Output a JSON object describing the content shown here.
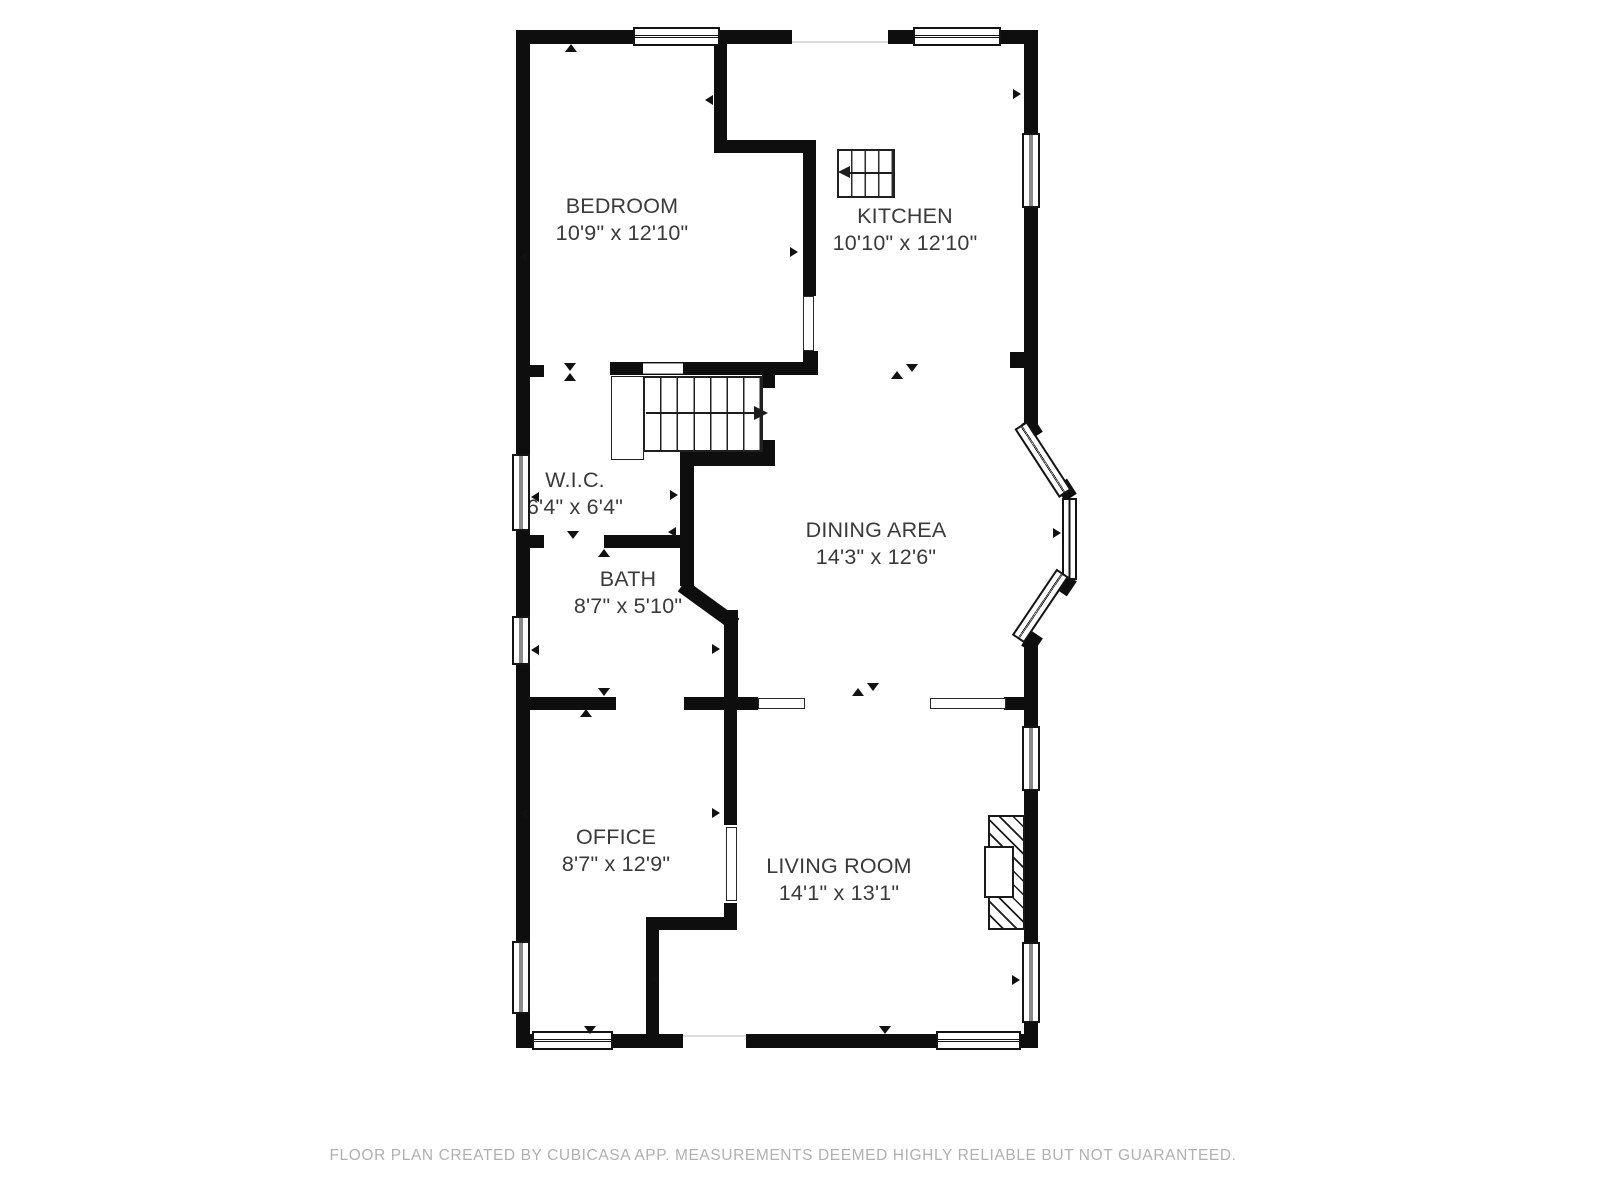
{
  "footer": "FLOOR PLAN CREATED BY CUBICASA APP. MEASUREMENTS DEEMED HIGHLY RELIABLE BUT NOT GUARANTEED.",
  "rooms": [
    {
      "id": "bedroom",
      "name": "BEDROOM",
      "dims": "10'9\" x 12'10\""
    },
    {
      "id": "kitchen",
      "name": "KITCHEN",
      "dims": "10'10\" x 12'10\""
    },
    {
      "id": "wic",
      "name": "W.I.C.",
      "dims": "6'4\" x 6'4\""
    },
    {
      "id": "bath",
      "name": "BATH",
      "dims": "8'7\" x 5'10\""
    },
    {
      "id": "dining",
      "name": "DINING AREA",
      "dims": "14'3\" x 12'6\""
    },
    {
      "id": "office",
      "name": "OFFICE",
      "dims": "8'7\" x 12'9\""
    },
    {
      "id": "living",
      "name": "LIVING ROOM",
      "dims": "14'1\" x 13'1\""
    }
  ],
  "stair_arrows": {
    "main": "right",
    "upper": "left"
  },
  "colors": {
    "wall": "#0e0e0e",
    "text": "#3a3a3a",
    "footer_text": "#b0b0b0",
    "background": "#ffffff"
  }
}
